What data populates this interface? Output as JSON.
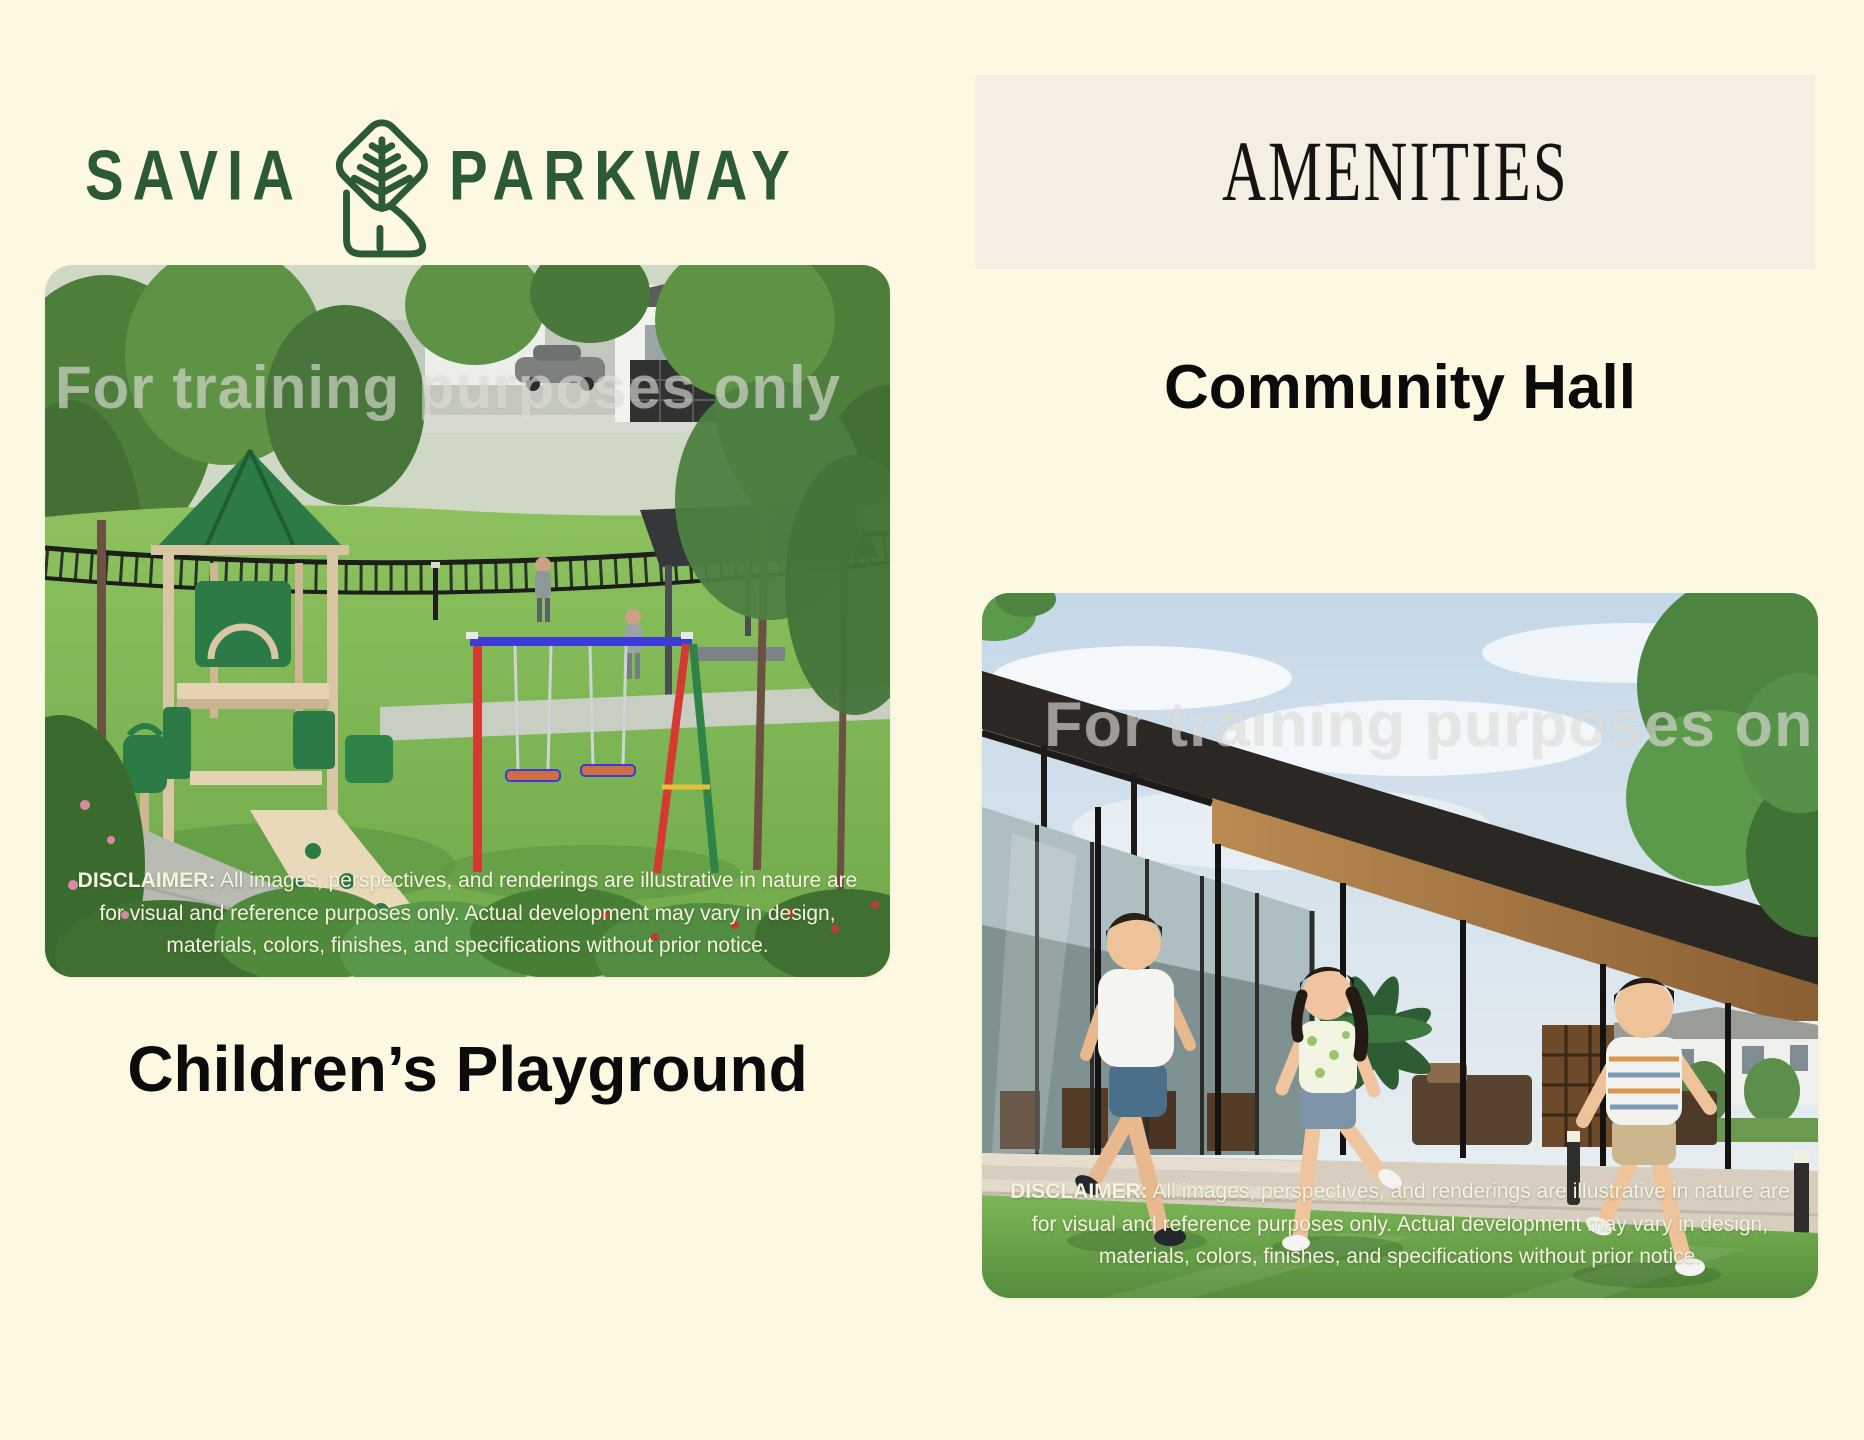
{
  "brand": {
    "name_left": "SAVIA",
    "name_right": "PARKWAY",
    "logo_color": "#2D5A36",
    "icon": "savia-tree-parkway-icon"
  },
  "header": {
    "title": "AMENITIES",
    "band_color": "#F4EFE2"
  },
  "watermark": {
    "text": "For training purposes only"
  },
  "sections": [
    {
      "title": "Children’s Playground",
      "image_name": "children-playground-rendering",
      "disclaimer": {
        "label": "DISCLAIMER:",
        "text": " All images, perspectives, and renderings are illustrative in nature are for visual and reference purposes only. Actual development may vary in design, materials, colors, finishes, and specifications without prior notice."
      }
    },
    {
      "title": "Community Hall",
      "image_name": "community-hall-rendering",
      "disclaimer": {
        "label": "DISCLAIMER:",
        "text": " All images, perspectives, and renderings are illustrative in nature are for visual and reference purposes only. Actual development may vary in design, materials, colors, finishes, and specifications without prior notice."
      }
    }
  ],
  "colors": {
    "page_background": "#FDF8E1",
    "amenities_band": "#F4EFE2",
    "heading_text": "#0B0B0B",
    "logo_green": "#2D5A36",
    "disclaimer_text": "#F5F2DF"
  }
}
